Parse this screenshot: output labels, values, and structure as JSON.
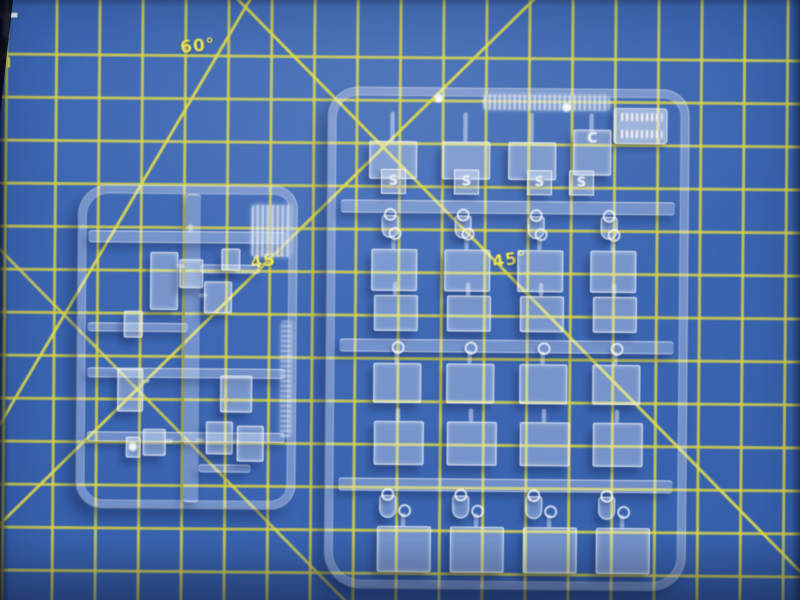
{
  "scene": {
    "type": "photograph",
    "description": "Two clear injection-molded model-kit sprues with transparent window parts lying on a blue self-healing cutting mat with a yellow grid and angle guide lines",
    "mat": {
      "surface_color": "#3a62ab",
      "grid_color": "#d8d44e",
      "grid_spacing_px": 43,
      "angle_labels": [
        {
          "id": "deg-60",
          "text": "60°"
        },
        {
          "id": "deg-45-left",
          "text": "45°"
        },
        {
          "id": "deg-45-right",
          "text": "45°"
        }
      ],
      "edge_text": {
        "letter_top": "T",
        "letter_bottom": "h"
      }
    },
    "sprues": {
      "small": {
        "description": "small clear sprue with frame, central runner and small rectangular clear parts",
        "part_count": 11
      },
      "large": {
        "description": "large clear sprue with rows of clear window parts on runners",
        "tag_letters": [
          "S",
          "S",
          "S",
          "S"
        ],
        "corner_letter": "C",
        "rows_of_parts": 6,
        "columns_of_parts": 4
      }
    }
  },
  "geometry": {
    "left_sprue": {
      "frame": [
        78,
        188,
        204,
        308
      ],
      "center_runner": [
        185,
        196,
        15,
        308
      ],
      "runners_h": [
        [
          88,
          233,
          198,
          12
        ],
        [
          200,
          266,
          60,
          9
        ],
        [
          88,
          325,
          100,
          9
        ],
        [
          88,
          370,
          198,
          10
        ],
        [
          88,
          434,
          198,
          10
        ],
        [
          200,
          466,
          52,
          8
        ]
      ],
      "tab": [
        251,
        206,
        40,
        52
      ],
      "script_strip": [
        281,
        322,
        11,
        116
      ],
      "parts": [
        [
          150,
          254,
          26,
          56
        ],
        [
          179,
          261,
          22,
          27
        ],
        [
          204,
          283,
          26,
          30
        ],
        [
          221,
          250,
          17,
          20
        ],
        [
          124,
          313,
          17,
          25
        ],
        [
          118,
          371,
          24,
          41
        ],
        [
          221,
          377,
          30,
          35
        ],
        [
          144,
          431,
          21,
          25
        ],
        [
          207,
          423,
          25,
          31
        ],
        [
          238,
          427,
          25,
          34
        ],
        [
          127,
          439,
          13,
          19
        ]
      ],
      "stems": [
        [
          176,
          266,
          8,
          4
        ],
        [
          199,
          295,
          8,
          4
        ],
        [
          142,
          381,
          8,
          4
        ],
        [
          166,
          441,
          8,
          4
        ],
        [
          197,
          440,
          8,
          4
        ],
        [
          232,
          441,
          8,
          4
        ],
        [
          188,
          226,
          4,
          8
        ]
      ]
    },
    "right_sprue": {
      "frame": [
        327,
        88,
        346,
        486
      ],
      "runners_h": [
        [
          340,
          200,
          334,
          13
        ],
        [
          340,
          339,
          334,
          13
        ],
        [
          340,
          478,
          334,
          13
        ]
      ],
      "top_text_strip": [
        482,
        94,
        126,
        15
      ],
      "corner_tab": [
        612,
        106,
        54,
        36
      ],
      "cols": [
        397,
        470,
        543,
        616
      ],
      "rows": [
        {
          "y": 141,
          "w": 46,
          "h": 36,
          "stem_top": 112,
          "cols": [
            391,
            464,
            530
          ]
        },
        {
          "y": 249,
          "w": 44,
          "h": 40,
          "dx": -4,
          "loops": true
        },
        {
          "y": 295,
          "w": 42,
          "h": 34,
          "dx": -2
        },
        {
          "y": 363,
          "w": 46,
          "h": 38,
          "loops": true
        },
        {
          "y": 421,
          "w": 48,
          "h": 42,
          "dx": 2
        },
        {
          "y": 526,
          "w": 52,
          "h": 44,
          "dx": 8,
          "loops": true
        }
      ],
      "c_part": [
        572,
        128,
        36,
        44
      ],
      "tag_x": [
        380,
        453,
        526,
        568
      ],
      "tag_y": 169,
      "hook_rows": [
        215,
        495
      ]
    },
    "sparks": [
      [
        129,
        443
      ],
      [
        432,
        92
      ],
      [
        560,
        100
      ]
    ]
  }
}
